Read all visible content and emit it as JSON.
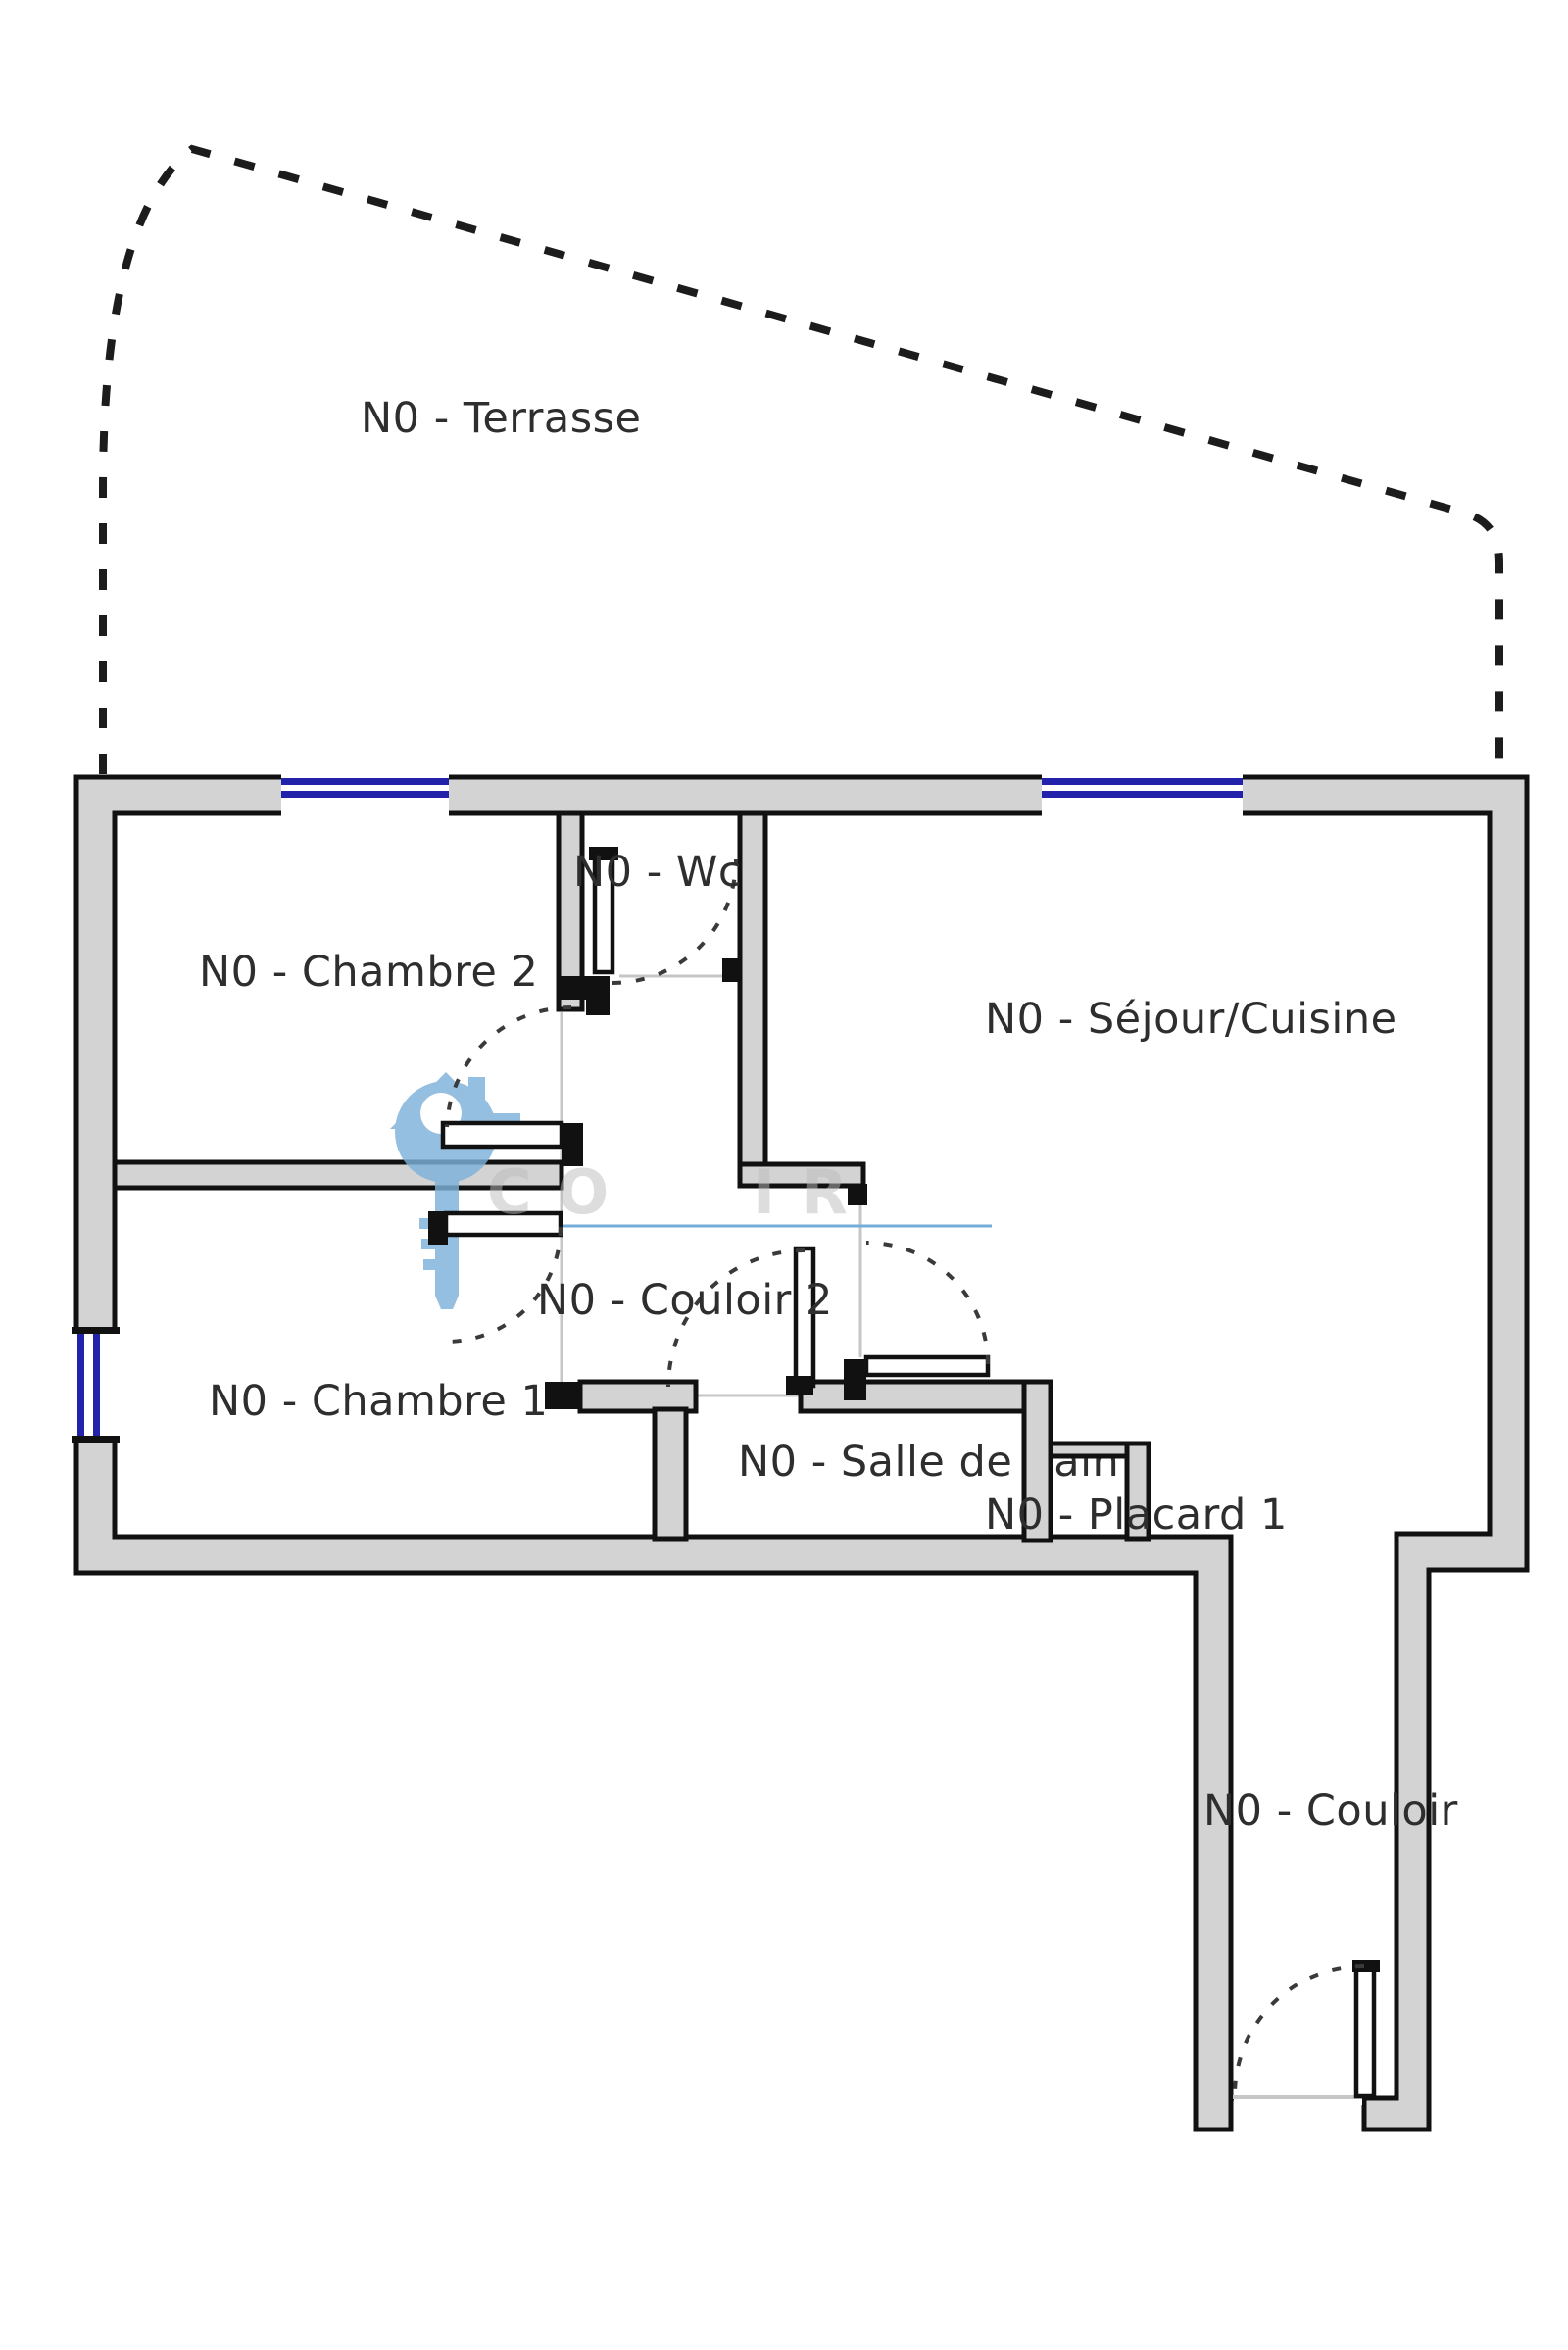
{
  "plan_title": "N0 floor plan",
  "rooms": {
    "terrasse": "N0 - Terrasse",
    "chambre2": "N0 - Chambre 2",
    "wc": "N0 - Wc",
    "sejour": "N0 - Séjour/Cuisine",
    "couloir2": "N0 - Couloir 2",
    "chambre1": "N0 - Chambre 1",
    "salle_de_bain": "N0 - Salle de bain",
    "placard": "N0 - Placard 1",
    "couloir": "N0 - Couloir"
  },
  "watermark": {
    "letters_left": "CO",
    "letters_right": "IR"
  },
  "colors": {
    "wall_fill": "#d3d3d3",
    "wall_stroke": "#111111",
    "window_blue": "#2222aa",
    "line_blue": "#74add8",
    "open_gray": "#c6c6c6",
    "arc_gray": "#3a3a3a",
    "wm_blue": "#7db1da",
    "label_color": "#2e2e2e",
    "dash_color": "#1c1c1c",
    "wm_text": "#bcbcbc"
  }
}
